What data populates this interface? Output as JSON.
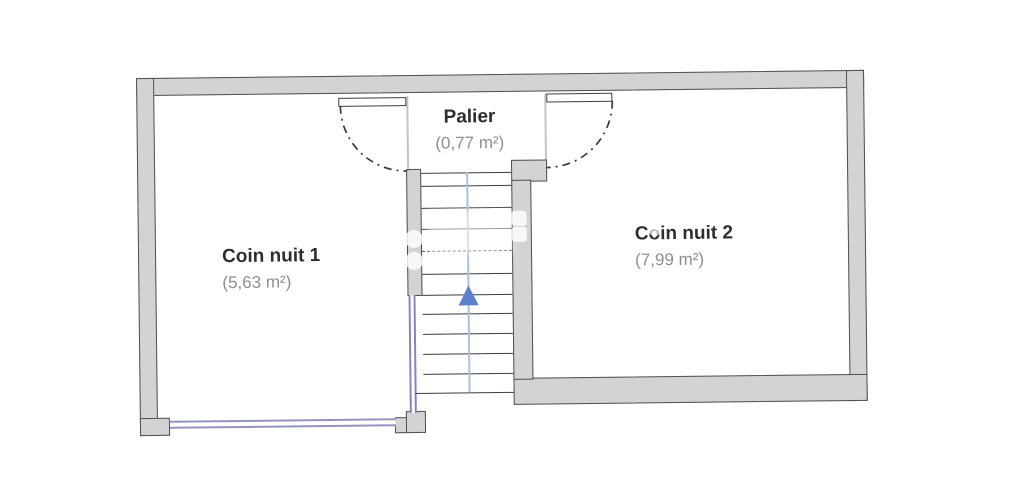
{
  "rooms": [
    {
      "name": "Palier",
      "area": "(0,77 m²)"
    },
    {
      "name": "Coin nuit 1",
      "area": "(5,63 m²)"
    },
    {
      "name": "Coin nuit 2",
      "area": "(7,99 m²)"
    }
  ],
  "stairs": {
    "direction": "up",
    "arrow_icon": "triangle-up"
  },
  "colors": {
    "wall_fill": "#d3d3d3",
    "wall_outline": "#4f4f4f",
    "window_frame": "#9394bb",
    "railing": "#8486c4",
    "walk_line": "#a9c2de",
    "stair_arrow": "#5c80cc",
    "tread_line": "#3c3c3c",
    "room_name_text": "#2e2e2e",
    "room_area_text": "#8f8f8f"
  }
}
